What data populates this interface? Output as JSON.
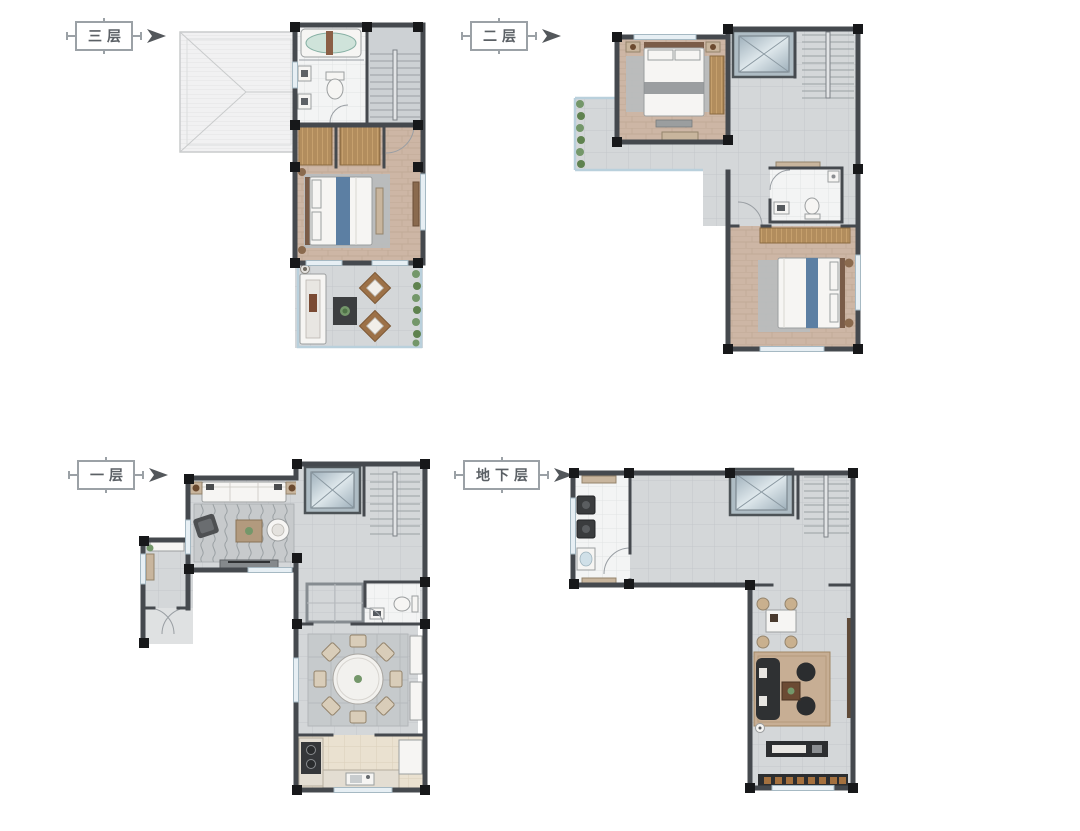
{
  "floors": [
    {
      "id": "third-floor",
      "label": "三层"
    },
    {
      "id": "second-floor",
      "label": "二层"
    },
    {
      "id": "first-floor",
      "label": "一层"
    },
    {
      "id": "basement",
      "label": "地下层"
    }
  ],
  "palette": {
    "wall": "#45494e",
    "corner_block": "#17181a",
    "tile_gray": "#d4d7d9",
    "tile_white": "#f3f4f4",
    "wood_floor": "#cdb6a5",
    "wardrobe_wood": "#c6a06d",
    "bed_white": "#f6f5f3",
    "bed_runner_blue": "#5c7fa3",
    "glass_railing_blue": "#b9d0dc",
    "plant_green": "#74976a",
    "roof_gray": "#f1f1f2",
    "rug_gray": "#b9bdbf",
    "rug_tan": "#c7ae94",
    "dark_furniture": "#2f3133",
    "kitchen_floor_beige": "#eae1d0",
    "label_border": "#9ba1a6",
    "label_text": "#5b6065",
    "arrow": "#53575b"
  }
}
